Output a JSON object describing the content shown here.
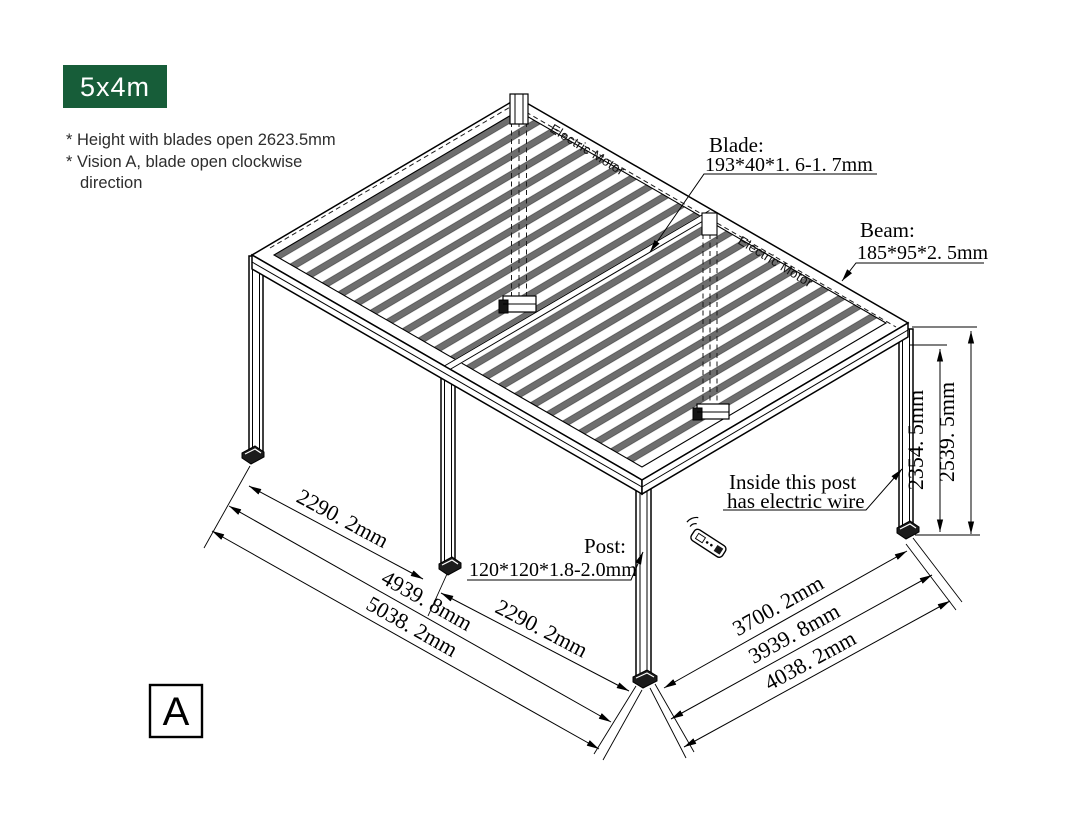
{
  "badge": {
    "label": "5x4m"
  },
  "notes": {
    "line1": "* Height with blades open 2623.5mm",
    "line2": "* Vision A, blade open clockwise",
    "line3": "direction"
  },
  "view_marker": {
    "label": "A"
  },
  "labels": {
    "electric_motor_top": "Electric Motor",
    "electric_motor_right": "Electric Motor",
    "blade_title": "Blade:",
    "blade_spec": "193*40*1. 6-1. 7mm",
    "beam_title": "Beam:",
    "beam_spec": "185*95*2. 5mm",
    "post_title": "Post:",
    "post_spec": "120*120*1.8-2.0mm",
    "wire_line1": "Inside this post",
    "wire_line2": "has electric wire"
  },
  "dimensions": {
    "front_left_span": "2290. 2mm",
    "front_left_span2": "2290. 2mm",
    "front_left_inner": "4939. 8mm",
    "front_left_outer": "5038. 2mm",
    "front_right_inner": "3700. 2mm",
    "front_right_mid": "3939. 8mm",
    "front_right_outer": "4038. 2mm",
    "height_to_beam": "2354. 5mm",
    "height_total": "2539. 5mm"
  },
  "colors": {
    "badge_bg": "#175d39",
    "louver": "#6e6e6e"
  }
}
